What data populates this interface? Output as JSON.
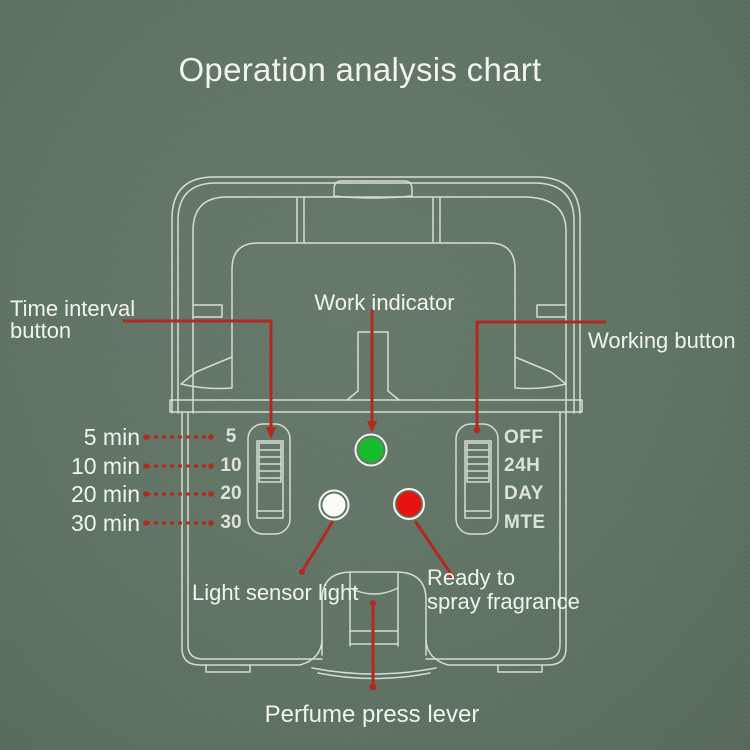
{
  "title": "Operation analysis chart",
  "labels": {
    "time_interval_button": {
      "line1": "Time interval",
      "line2": "button"
    },
    "work_indicator": "Work indicator",
    "working_button": "Working button",
    "light_sensor_light": "Light sensor light",
    "ready_to_spray": {
      "line1": "Ready to",
      "line2": "spray fragrance"
    },
    "perfume_press_lever": "Perfume press lever"
  },
  "time_options": [
    {
      "label": "5 min",
      "mark": "5"
    },
    {
      "label": "10 min",
      "mark": "10"
    },
    {
      "label": "20 min",
      "mark": "20"
    },
    {
      "label": "30 min",
      "mark": "30"
    }
  ],
  "working_modes": [
    "OFF",
    "24H",
    "DAY",
    "MTE"
  ],
  "colors": {
    "background": "#5f7364",
    "line_art": "#e7ebe2",
    "callout_red": "#b3281f",
    "indicator_green": "#19bb2e",
    "indicator_red": "#e61310",
    "indicator_white": "#fbfcf8",
    "text": "#f1f4ec"
  }
}
